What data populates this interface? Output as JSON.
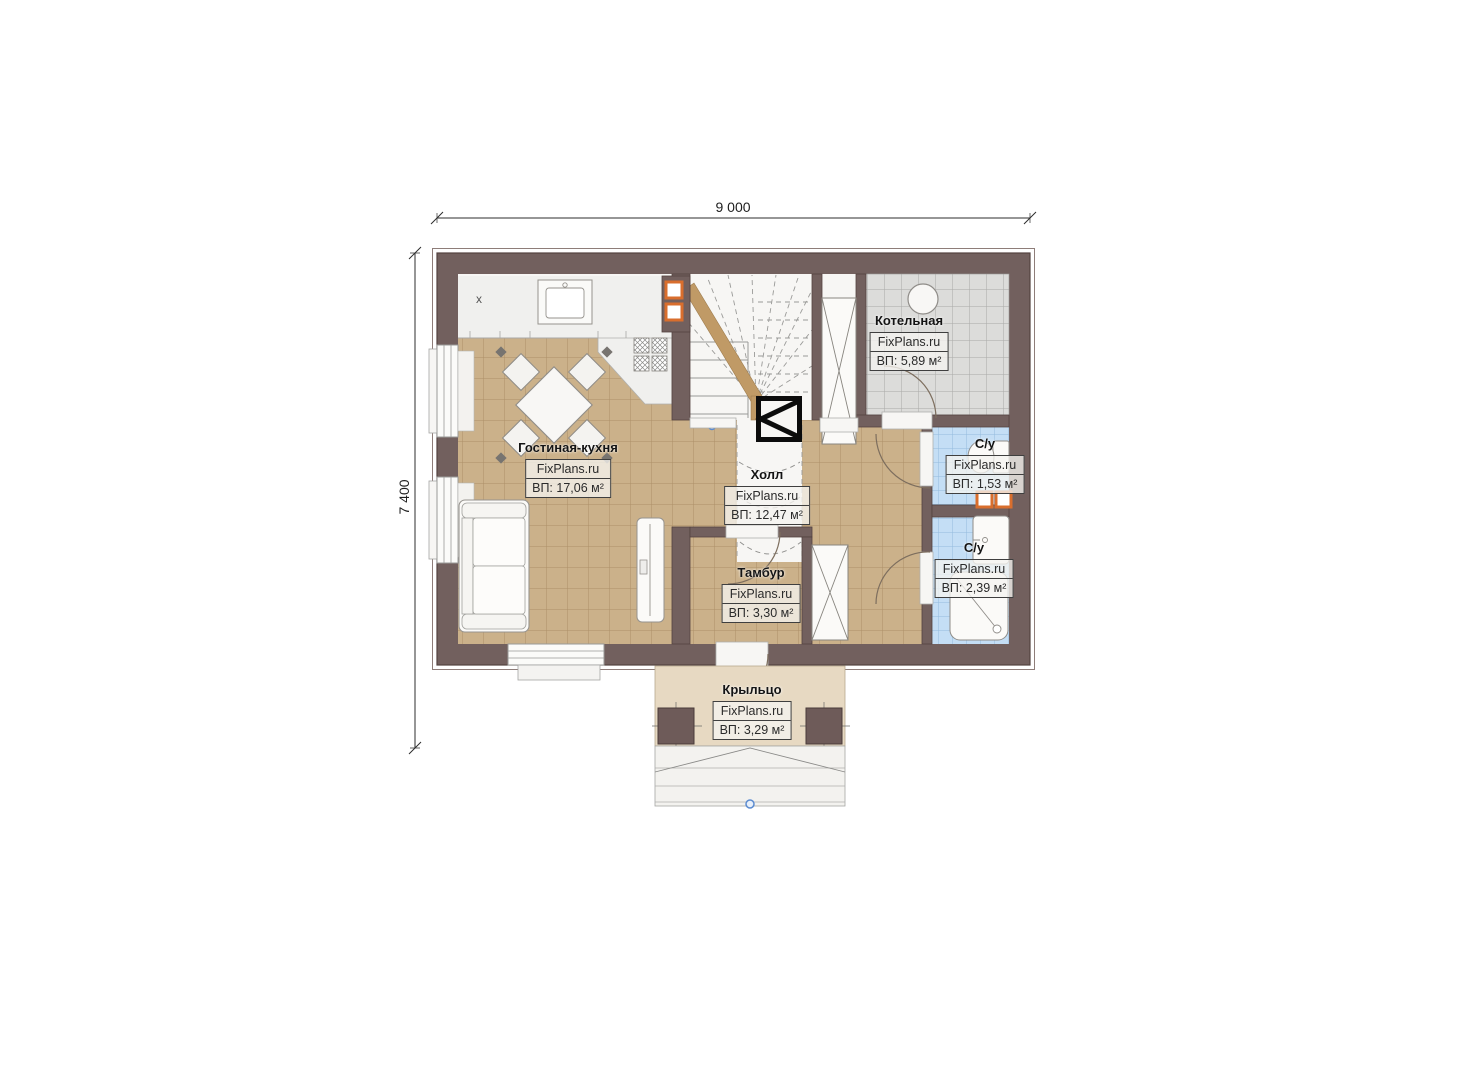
{
  "dimensions": {
    "width_label": "9 000",
    "height_label": "7 400"
  },
  "rooms": [
    {
      "key": "living_kitchen",
      "name": "Гостиная-кухня",
      "brand": "FixPlans.ru",
      "area": "ВП: 17,06 м²"
    },
    {
      "key": "hall",
      "name": "Холл",
      "brand": "FixPlans.ru",
      "area": "ВП: 12,47 м²"
    },
    {
      "key": "boiler_room",
      "name": "Котельная",
      "brand": "FixPlans.ru",
      "area": "ВП: 5,89 м²"
    },
    {
      "key": "wc_small",
      "name": "С/у",
      "brand": "FixPlans.ru",
      "area": "ВП: 1,53 м²"
    },
    {
      "key": "wc_shower",
      "name": "С/у",
      "brand": "FixPlans.ru",
      "area": "ВП: 2,39 м²"
    },
    {
      "key": "vestibule",
      "name": "Тамбур",
      "brand": "FixPlans.ru",
      "area": "ВП: 3,30 м²"
    },
    {
      "key": "porch",
      "name": "Крыльцо",
      "brand": "FixPlans.ru",
      "area": "ВП: 3,29 м²"
    }
  ],
  "kitchen": {
    "appliance_mark": "x"
  },
  "colors": {
    "wall": "#72605e",
    "floor_tan": "#cbb18a",
    "floor_gray": "#dcdcda",
    "floor_blue": "#c4def5",
    "porch_fill": "#e7d9c2",
    "accent_orange": "#d96e2d"
  }
}
